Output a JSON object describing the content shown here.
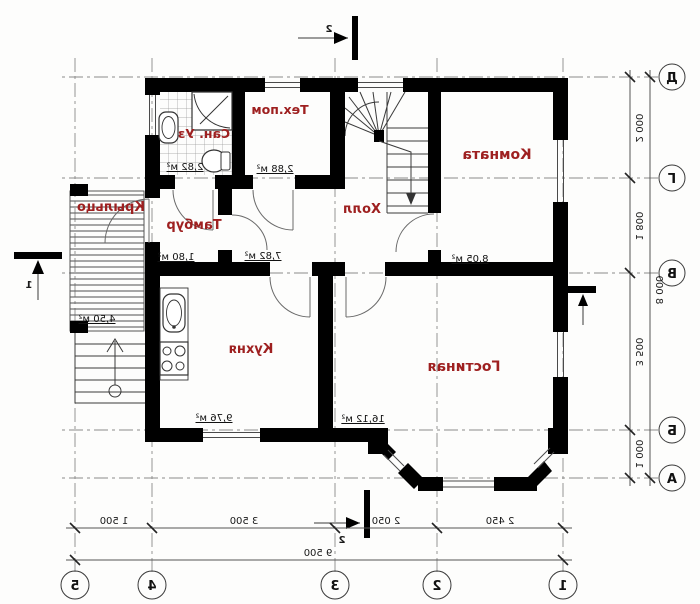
{
  "rooms": [
    {
      "name": "Сан. Уз",
      "area": "2,82 м²"
    },
    {
      "name": "Тех.пом",
      "area": "2,88 м²"
    },
    {
      "name": "Тамбур",
      "area": "1,80 м²"
    },
    {
      "name": "Холл",
      "area": "7,82 м²"
    },
    {
      "name": "Комната",
      "area": "8,05 м²"
    },
    {
      "name": "Кухня",
      "area": "9,76 м²"
    },
    {
      "name": "Гостиная",
      "area": "16,12 м²"
    },
    {
      "name": "Крыльцо",
      "area": "4,50 м²"
    }
  ],
  "axes": {
    "letters": [
      "Д",
      "Г",
      "В",
      "Б",
      "А"
    ],
    "numbers": [
      "1",
      "2",
      "3",
      "4",
      "5"
    ]
  },
  "dims": {
    "left": [
      "2 000",
      "1 800",
      "3 500",
      "1 000"
    ],
    "left_total": "8 000",
    "bottom": [
      "2 450",
      "2 050",
      "3 500",
      "1 500"
    ],
    "bottom_total": "9 500"
  },
  "marks": {
    "vertical": "2",
    "horizontal": "1"
  },
  "colors": {
    "wall": "#000000",
    "room_label": "#9e2020",
    "dashed_axis": "#8a8a8a"
  }
}
